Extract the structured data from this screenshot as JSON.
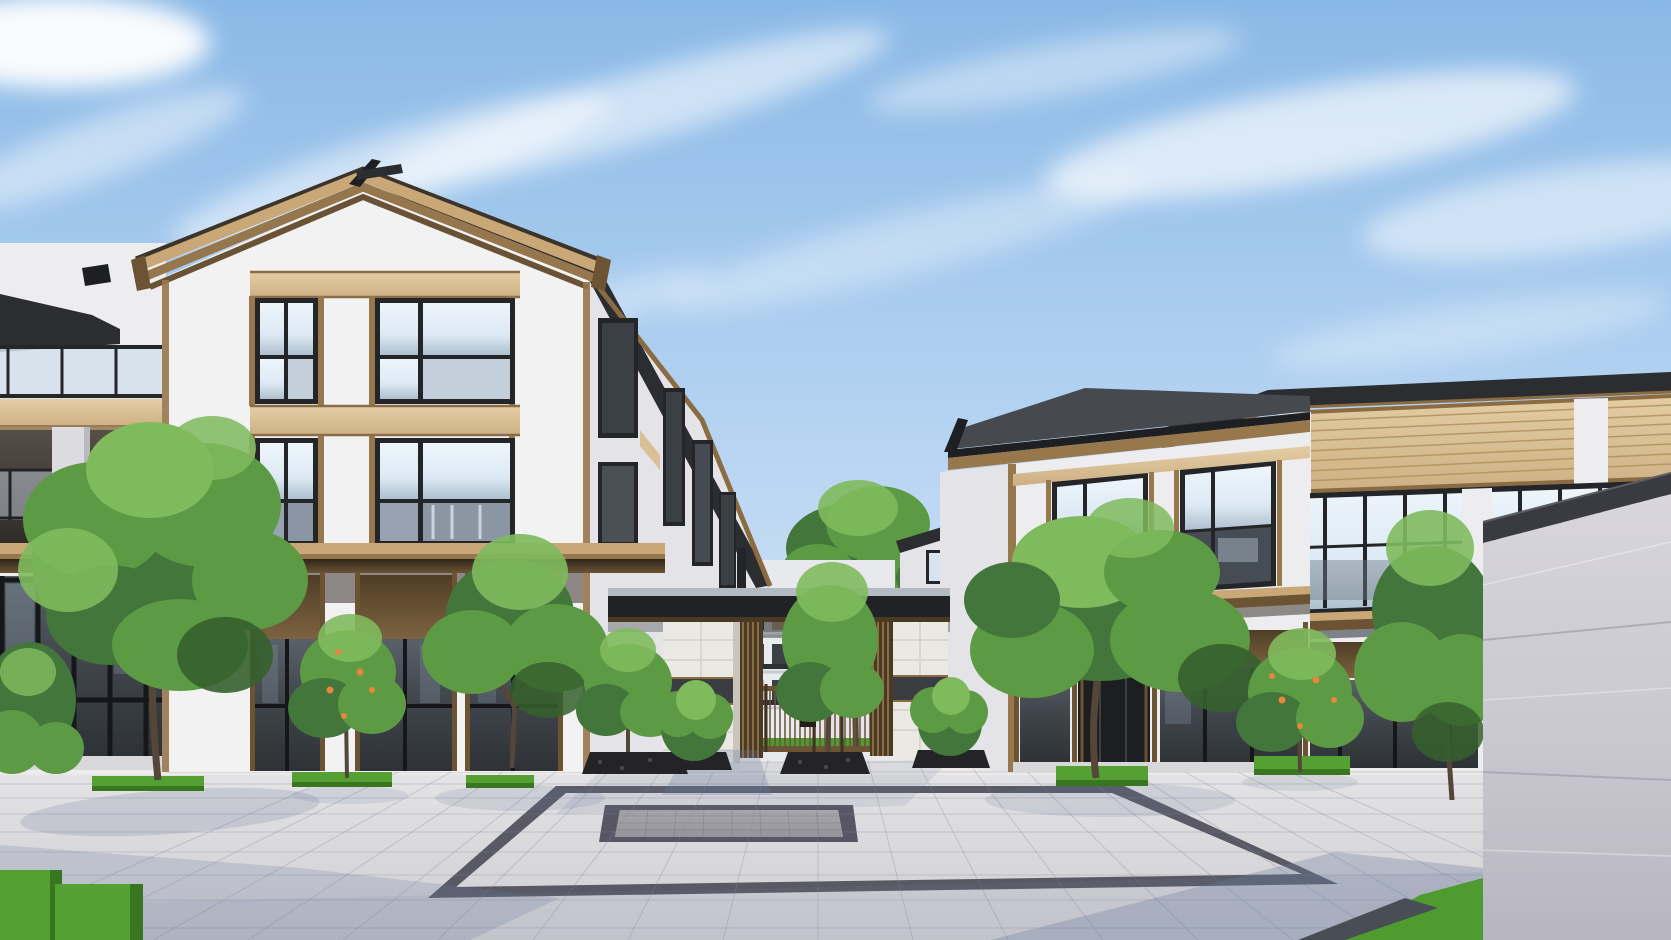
{
  "scene": {
    "type": "Architectural exterior rendering of a modern Chinese-style residential compound entrance",
    "time_of_day": "daytime",
    "sky": {
      "condition": "blue sky with thin wispy cirrus clouds"
    },
    "left_building": {
      "storeys": "3",
      "roof": "front gable with layered bronze trim and dark ridge finial",
      "facade": "white panels, bronze-framed windows, tan spandrel bands, bronze canopy over shaded bronze-panel ground floor",
      "wing": "receding side wing toward gate with narrow windows and descending dark eave"
    },
    "far_left_building": {
      "features": "stepped terraces, dark-framed glass balustrades, tan fascia bands, recessed balcony with white column, dark glazed ground floor"
    },
    "right_building": {
      "storeys": "2",
      "roof": "dark standing-seam roofs with bronze fascia, taller rear mass",
      "facade": "white piers, tan slatted clerestory, large bronze-framed glazing, bronze mid canopy, dark recessed entrance"
    },
    "entry_gate": {
      "canopy": "flat dark slab spanning between buildings",
      "pillars": "white stone piers with dark granite band",
      "screens": "vertical bronze louver columns",
      "gate": "bronze vertical-bar double gate with small dark sign plate",
      "view_through": "courtyard with multi-storey white residences, lawns and mature trees"
    },
    "plaza": {
      "paving": "light granite tiles in perspective grid",
      "feature": "grey inset carpet panel framed by dark granite border band",
      "shadows": "soft blue shadows from gate, trees and foreground wall"
    },
    "landscaping": {
      "trees": "deciduous trees, clipped round shrubs, persimmon trees with orange fruit",
      "planters": "low clipped hedge boxes and black-pebble planter beds"
    },
    "foreground": {
      "right_wall": "light grey stone screen wall with dark coping",
      "wall_base": "lawn strip and dark stone path"
    }
  },
  "palette": {
    "sky_top": "#8ab8e6",
    "sky_mid": "#b5d3f0",
    "sky_horizon": "#e8f1fa",
    "cloud": "#ffffff",
    "roof_dark": "#2b2d30",
    "roof_plane": "#46494e",
    "roof_black": "#1d1f22",
    "roof_seam": "#8b9096",
    "bronze_light": "#c9a777",
    "bronze_mid": "#97774c",
    "bronze_dark": "#6b5334",
    "bronze_deep": "#4a3a24",
    "tan_panel": "#d8bb8d",
    "tan_light": "#e6d0a9",
    "wall_white": "#ededef",
    "wall_light": "#f2f2f3",
    "wall_shade": "#dedee2",
    "wall_side": "#e4e4e8",
    "wall_distant": "#e7e9ec",
    "frame_dark": "#232528",
    "glass_sky": "#d7e4f0",
    "glass_mid": "#9fb0c0",
    "glass_dark": "#3a4045",
    "glass_deep": "#2d3135",
    "stone_white": "#ebe9e4",
    "granite_band": "#3c3c43",
    "beam_top": "#b3bac1",
    "beam_body": "#202225",
    "pave_far": "#e9e8e9",
    "pave_near": "#cfced3",
    "pave_border": "#4e4e5a",
    "inset_border": "#585664",
    "inset_gray": "#a3a2a8",
    "hedge_green": "#55a032",
    "hedge_dark": "#38761f",
    "grass_green": "#4e9c30",
    "foliage_light": "#7fba5d",
    "foliage_mid": "#5d9a44",
    "foliage_dark": "#42763a",
    "foliage_deep": "#35602c",
    "trunk_brown": "#55463a",
    "planter_rock": "#242428",
    "fruit_orange": "#e8863a",
    "fgwall_top": "#d8d6dc",
    "fgwall_bottom": "#b7b5bf",
    "fgwall_cap": "#393b40",
    "shadow_blue": "#6a7a9e"
  }
}
